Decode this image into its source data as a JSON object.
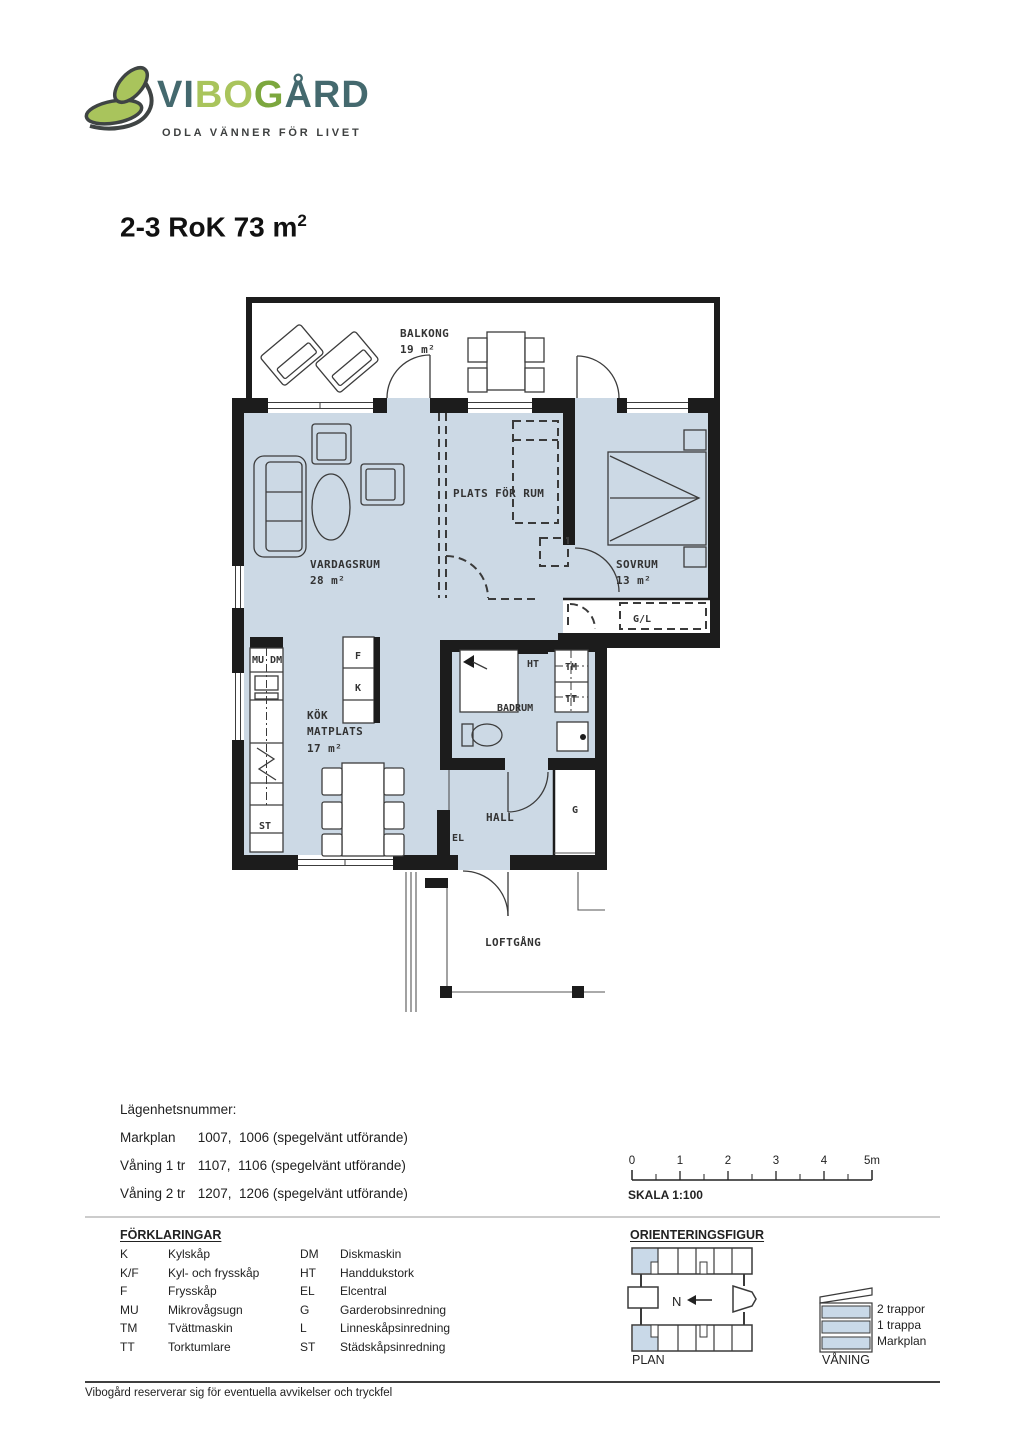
{
  "logo": {
    "vi": "VI",
    "bo": "BO",
    "g": "G",
    "ard": "ÅRD",
    "tagline": "ODLA VÄNNER FÖR LIVET"
  },
  "title": {
    "text": "2-3 RoK 73 m",
    "sup": "2"
  },
  "plan": {
    "balkong": "BALKONG",
    "balkong_area": "19 m²",
    "vardagsrum": "VARDAGSRUM",
    "vardagsrum_area": "28 m²",
    "plats_for_rum": "PLATS FÖR RUM",
    "sovrum": "SOVRUM",
    "sovrum_area": "13 m²",
    "kok": "KÖK",
    "matplats": "MATPLATS",
    "kok_area": "17 m²",
    "badrum": "BADRUM",
    "hall": "HALL",
    "loftgang": "LOFTGÅNG",
    "gl": "G/L",
    "ht": "HT",
    "tm": "TM",
    "tt": "TT",
    "el": "EL",
    "g": "G",
    "st": "ST",
    "mu_dm": "MU DM",
    "f": "F",
    "k": "K"
  },
  "apartment": {
    "heading": "Lägenhetsnummer:",
    "rows": [
      {
        "label": "Markplan",
        "value": "1007,  1006 (spegelvänt utförande)"
      },
      {
        "label": "Våning 1 tr",
        "value": "1107,  1106 (spegelvänt utförande)"
      },
      {
        "label": "Våning 2 tr",
        "value": "1207,  1206 (spegelvänt utförande)"
      }
    ]
  },
  "scale": {
    "ticks": [
      "0",
      "1",
      "2",
      "3",
      "4",
      "5m"
    ],
    "caption": "SKALA 1:100"
  },
  "legend": {
    "heading": "FÖRKLARINGAR",
    "left": [
      {
        "code": "K",
        "desc": "Kylskåp"
      },
      {
        "code": "K/F",
        "desc": "Kyl- och frysskåp"
      },
      {
        "code": "F",
        "desc": "Frysskåp"
      },
      {
        "code": "MU",
        "desc": "Mikrovågsugn"
      },
      {
        "code": "TM",
        "desc": "Tvättmaskin"
      },
      {
        "code": "TT",
        "desc": "Torktumlare"
      }
    ],
    "right": [
      {
        "code": "DM",
        "desc": "Diskmaskin"
      },
      {
        "code": "HT",
        "desc": "Handdukstork"
      },
      {
        "code": "EL",
        "desc": "Elcentral"
      },
      {
        "code": "G",
        "desc": "Garderobsinredning"
      },
      {
        "code": "L",
        "desc": "Linneskåpsinredning"
      },
      {
        "code": "ST",
        "desc": "Städskåpsinredning"
      }
    ]
  },
  "orientation": {
    "heading": "ORIENTERINGSFIGUR",
    "north": "N",
    "plan_label": "PLAN"
  },
  "elevation": {
    "floors": [
      "2 trappor",
      "1 trappa",
      "Markplan"
    ],
    "caption": "VÅNING"
  },
  "footer": {
    "disclaimer": "Vibogård reserverar sig för eventuella avvikelser och tryckfel"
  },
  "colors": {
    "room_fill": "#ccd9e5",
    "wall": "#1c1c1c",
    "teal": "#44696e",
    "green_light": "#a9c45c",
    "green": "#7ca73e"
  }
}
